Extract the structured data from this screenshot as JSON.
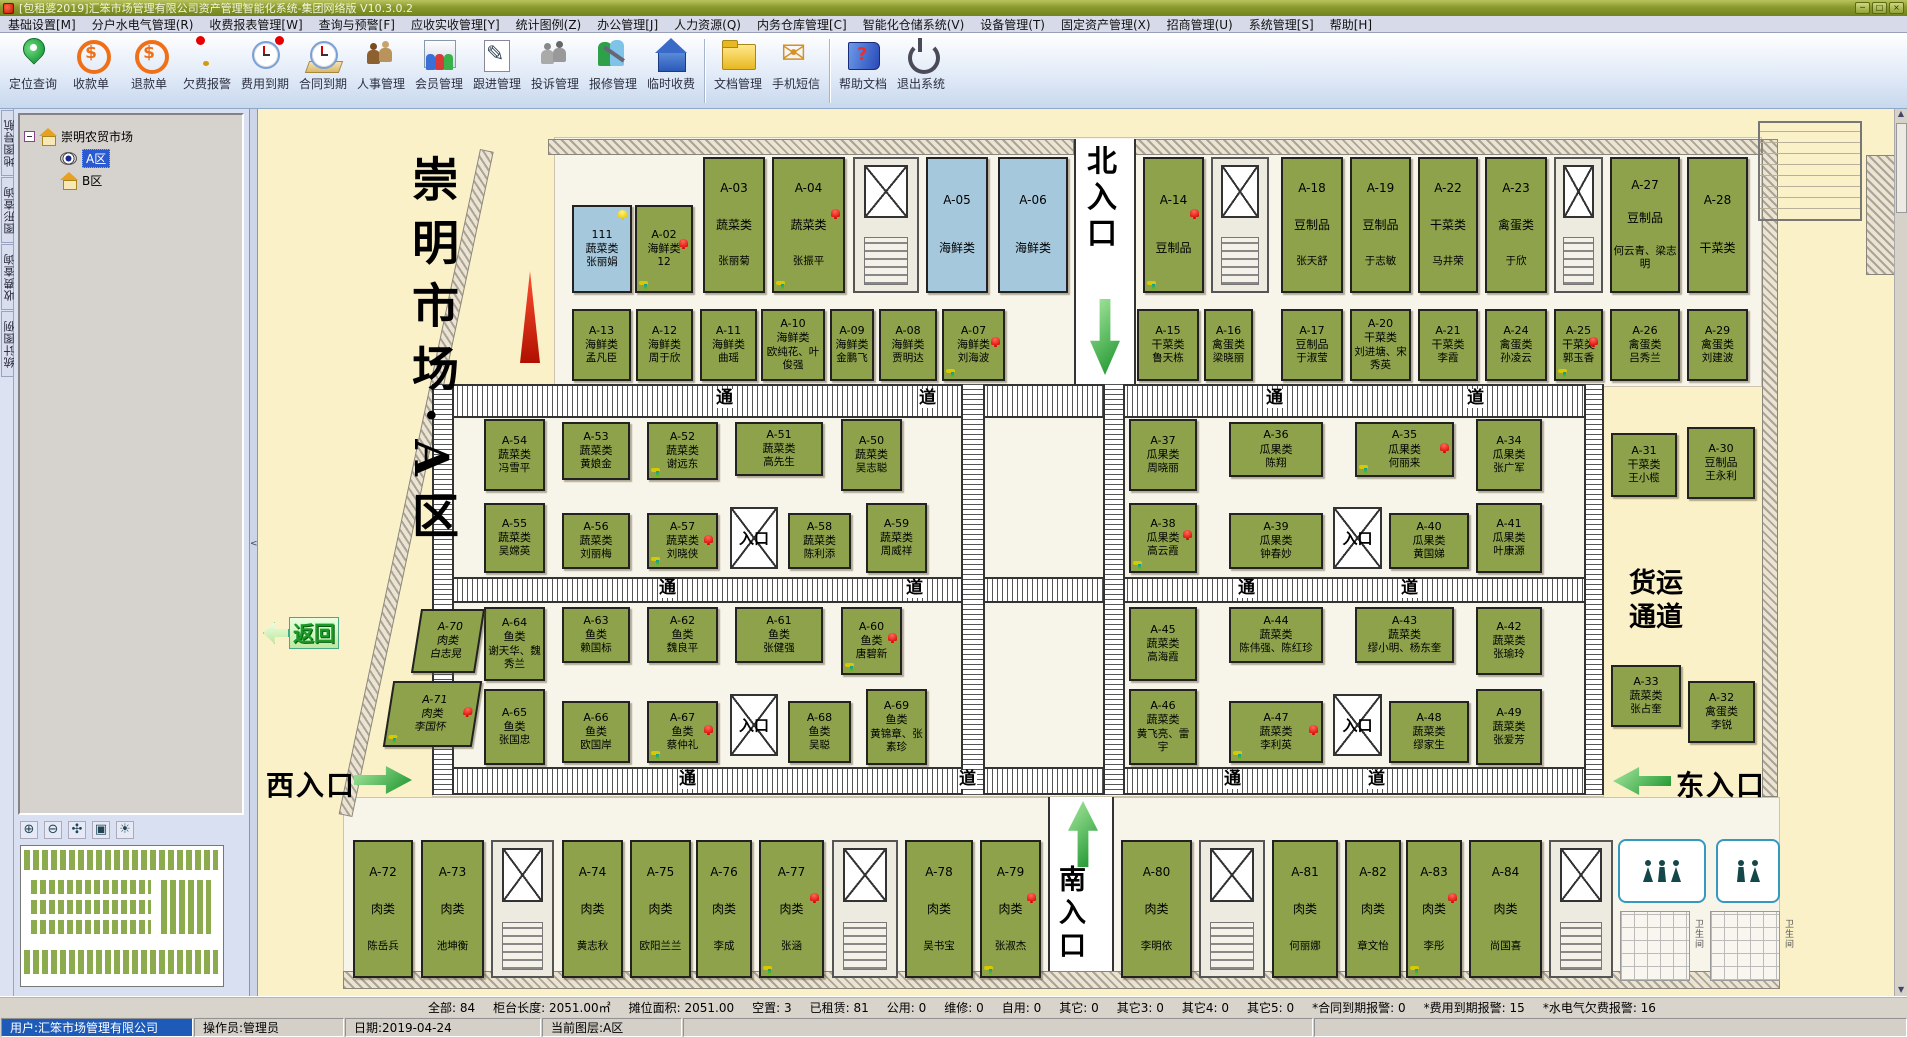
{
  "window": {
    "title": "[包租婆2019]汇笨市场管理有限公司资产管理智能化系统-集团网络版 V10.3.0.2",
    "buttons": {
      "minimize": "─",
      "maximize": "□",
      "close": "×"
    }
  },
  "menu": {
    "items": [
      "基础设置[M]",
      "分户水电气管理(R)",
      "收费报表管理[W]",
      "查询与预警[F]",
      "应收实收管理[Y]",
      "统计图例(Z)",
      "办公管理[J]",
      "人力资源(Q)",
      "内务仓库管理[C]",
      "智能化仓储系统(V)",
      "设备管理(T)",
      "固定资产管理(X)",
      "招商管理(U)",
      "系统管理[S]",
      "帮助[H]"
    ]
  },
  "toolbar": {
    "items": [
      {
        "label": "定位查询",
        "icon": "locate-icon"
      },
      {
        "label": "收款单",
        "icon": "receipt-icon"
      },
      {
        "label": "退款单",
        "icon": "refund-icon"
      },
      {
        "label": "欠费报警",
        "icon": "arrears-alarm-icon"
      },
      {
        "label": "费用到期",
        "icon": "fee-due-icon"
      },
      {
        "label": "合同到期",
        "icon": "contract-due-icon"
      },
      {
        "label": "人事管理",
        "icon": "hr-icon"
      },
      {
        "label": "会员管理",
        "icon": "members-icon"
      },
      {
        "label": "跟进管理",
        "icon": "followup-icon"
      },
      {
        "label": "投诉管理",
        "icon": "complaints-icon"
      },
      {
        "label": "报修管理",
        "icon": "repair-icon"
      },
      {
        "label": "临时收费",
        "icon": "temp-fee-icon"
      },
      {
        "label": "文档管理",
        "icon": "documents-icon"
      },
      {
        "label": "手机短信",
        "icon": "sms-icon"
      },
      {
        "label": "帮助文档",
        "icon": "help-icon"
      },
      {
        "label": "退出系统",
        "icon": "exit-icon"
      }
    ],
    "separators_after": [
      11,
      13
    ]
  },
  "sidebar": {
    "tabs": [
      "地图导航",
      "图形查询",
      "收费查询",
      "统计图例"
    ],
    "tree": {
      "root": "崇明农贸市场",
      "nodes": [
        {
          "label": "A区",
          "selected": true
        },
        {
          "label": "B区",
          "selected": false
        }
      ]
    }
  },
  "map": {
    "labels": {
      "title": "崇明市场·A区",
      "north": "北入口",
      "south": "南入口",
      "west": "西入口",
      "east": "东入口",
      "back": "返回",
      "freight": "货运 通道",
      "entrance": "入口",
      "restroom": "卫生间"
    },
    "colors": {
      "occupied": "#8da24b",
      "vacant": "#a6c8dc",
      "alarm_bell": "#d80000",
      "warn_bell": "#e8c400"
    },
    "corridor_chars": [
      {
        "t": "通",
        "x": 457,
        "y": 280
      },
      {
        "t": "道",
        "x": 660,
        "y": 280
      },
      {
        "t": "通",
        "x": 1007,
        "y": 280
      },
      {
        "t": "道",
        "x": 1208,
        "y": 280
      },
      {
        "t": "通",
        "x": 400,
        "y": 470
      },
      {
        "t": "道",
        "x": 647,
        "y": 470
      },
      {
        "t": "通",
        "x": 979,
        "y": 470
      },
      {
        "t": "道",
        "x": 1142,
        "y": 470
      },
      {
        "t": "通",
        "x": 420,
        "y": 661
      },
      {
        "t": "道",
        "x": 700,
        "y": 661
      },
      {
        "t": "通",
        "x": 965,
        "y": 661
      },
      {
        "t": "道",
        "x": 1109,
        "y": 661
      }
    ],
    "entrance_boxes": [
      {
        "x": 472,
        "y": 398,
        "w": 48,
        "h": 62
      },
      {
        "x": 1075,
        "y": 398,
        "w": 49,
        "h": 62
      },
      {
        "x": 472,
        "y": 585,
        "w": 48,
        "h": 62
      },
      {
        "x": 1075,
        "y": 585,
        "w": 49,
        "h": 62
      }
    ],
    "structs": [
      {
        "x": 595,
        "y": 48,
        "w": 66,
        "h": 136
      },
      {
        "x": 953,
        "y": 48,
        "w": 58,
        "h": 136
      },
      {
        "x": 1296,
        "y": 48,
        "w": 49,
        "h": 136
      },
      {
        "x": 233,
        "y": 731,
        "w": 63,
        "h": 138
      },
      {
        "x": 574,
        "y": 731,
        "w": 66,
        "h": 138
      },
      {
        "x": 941,
        "y": 731,
        "w": 66,
        "h": 138
      },
      {
        "x": 1291,
        "y": 731,
        "w": 64,
        "h": 138
      }
    ],
    "stalls": [
      {
        "i": "111",
        "c": "蔬菜类",
        "n": "张丽娟",
        "x": 314,
        "y": 96,
        "w": 60,
        "h": 88,
        "t": "b",
        "b": "y"
      },
      {
        "i": "A-02",
        "c": "海鲜类",
        "n": "12",
        "x": 377,
        "y": 96,
        "w": 58,
        "h": 88,
        "t": "g",
        "b": "r",
        "tp": 1
      },
      {
        "i": "A-03",
        "c": "蔬菜类",
        "n": "张丽菊",
        "x": 445,
        "y": 48,
        "w": 62,
        "h": 136,
        "t": "g"
      },
      {
        "i": "A-04",
        "c": "蔬菜类",
        "n": "张振平",
        "x": 514,
        "y": 48,
        "w": 73,
        "h": 136,
        "t": "g",
        "b": "r",
        "tp": 1
      },
      {
        "i": "A-05",
        "c": "海鲜类",
        "n": "",
        "x": 668,
        "y": 48,
        "w": 62,
        "h": 136,
        "t": "b"
      },
      {
        "i": "A-06",
        "c": "海鲜类",
        "n": "",
        "x": 740,
        "y": 48,
        "w": 70,
        "h": 136,
        "t": "b"
      },
      {
        "i": "A-14",
        "c": "豆制品",
        "n": "",
        "x": 885,
        "y": 48,
        "w": 61,
        "h": 136,
        "t": "g",
        "b": "r",
        "tp": 1
      },
      {
        "i": "A-18",
        "c": "豆制品",
        "n": "张天舒",
        "x": 1023,
        "y": 48,
        "w": 62,
        "h": 136,
        "t": "g"
      },
      {
        "i": "A-19",
        "c": "豆制品",
        "n": "于志敏",
        "x": 1092,
        "y": 48,
        "w": 61,
        "h": 136,
        "t": "g"
      },
      {
        "i": "A-22",
        "c": "干菜类",
        "n": "马井荣",
        "x": 1160,
        "y": 48,
        "w": 60,
        "h": 136,
        "t": "g"
      },
      {
        "i": "A-23",
        "c": "禽蛋类",
        "n": "于欣",
        "x": 1227,
        "y": 48,
        "w": 62,
        "h": 136,
        "t": "g"
      },
      {
        "i": "A-27",
        "c": "豆制品",
        "n": "何云青、梁志明",
        "x": 1352,
        "y": 48,
        "w": 70,
        "h": 136,
        "t": "g"
      },
      {
        "i": "A-28",
        "c": "干菜类",
        "n": "",
        "x": 1429,
        "y": 48,
        "w": 61,
        "h": 136,
        "t": "g"
      },
      {
        "i": "A-13",
        "c": "海鲜类",
        "n": "孟凡臣",
        "x": 314,
        "y": 200,
        "w": 59,
        "h": 72,
        "t": "g"
      },
      {
        "i": "A-12",
        "c": "海鲜类",
        "n": "周于欣",
        "x": 378,
        "y": 200,
        "w": 57,
        "h": 72,
        "t": "g"
      },
      {
        "i": "A-11",
        "c": "海鲜类",
        "n": "曲瑶",
        "x": 442,
        "y": 200,
        "w": 57,
        "h": 72,
        "t": "g"
      },
      {
        "i": "A-10",
        "c": "海鲜类",
        "n": "欧纯花、叶俊强",
        "x": 503,
        "y": 200,
        "w": 64,
        "h": 72,
        "t": "g"
      },
      {
        "i": "A-09",
        "c": "海鲜类",
        "n": "金鹏飞",
        "x": 572,
        "y": 200,
        "w": 44,
        "h": 72,
        "t": "g"
      },
      {
        "i": "A-08",
        "c": "海鲜类",
        "n": "贾明达",
        "x": 621,
        "y": 200,
        "w": 58,
        "h": 72,
        "t": "g"
      },
      {
        "i": "A-07",
        "c": "海鲜类",
        "n": "刘海波",
        "x": 684,
        "y": 200,
        "w": 63,
        "h": 72,
        "t": "g",
        "b": "r",
        "tp": 1
      },
      {
        "i": "A-15",
        "c": "干菜类",
        "n": "鲁天栋",
        "x": 879,
        "y": 200,
        "w": 62,
        "h": 72,
        "t": "g"
      },
      {
        "i": "A-16",
        "c": "禽蛋类",
        "n": "梁晓丽",
        "x": 946,
        "y": 200,
        "w": 49,
        "h": 72,
        "t": "g"
      },
      {
        "i": "A-17",
        "c": "豆制品",
        "n": "于淑莹",
        "x": 1023,
        "y": 200,
        "w": 62,
        "h": 72,
        "t": "g"
      },
      {
        "i": "A-20",
        "c": "干菜类",
        "n": "刘进塘、宋秀英",
        "x": 1092,
        "y": 200,
        "w": 61,
        "h": 72,
        "t": "g"
      },
      {
        "i": "A-21",
        "c": "干菜类",
        "n": "李霞",
        "x": 1160,
        "y": 200,
        "w": 60,
        "h": 72,
        "t": "g"
      },
      {
        "i": "A-24",
        "c": "禽蛋类",
        "n": "孙凌云",
        "x": 1227,
        "y": 200,
        "w": 62,
        "h": 72,
        "t": "g"
      },
      {
        "i": "A-25",
        "c": "干菜类",
        "n": "郭玉香",
        "x": 1296,
        "y": 200,
        "w": 49,
        "h": 72,
        "t": "g",
        "b": "r",
        "tp": 1
      },
      {
        "i": "A-26",
        "c": "禽蛋类",
        "n": "吕秀兰",
        "x": 1352,
        "y": 200,
        "w": 70,
        "h": 72,
        "t": "g"
      },
      {
        "i": "A-29",
        "c": "禽蛋类",
        "n": "刘建波",
        "x": 1429,
        "y": 200,
        "w": 61,
        "h": 72,
        "t": "g"
      },
      {
        "i": "A-54",
        "c": "蔬菜类",
        "n": "冯雪平",
        "x": 226,
        "y": 310,
        "w": 61,
        "h": 72,
        "t": "g"
      },
      {
        "i": "A-53",
        "c": "蔬菜类",
        "n": "黄娘金",
        "x": 304,
        "y": 313,
        "w": 68,
        "h": 58,
        "t": "g"
      },
      {
        "i": "A-52",
        "c": "蔬菜类",
        "n": "谢远东",
        "x": 389,
        "y": 313,
        "w": 71,
        "h": 58,
        "t": "g",
        "tp": 1
      },
      {
        "i": "A-51",
        "c": "蔬菜类",
        "n": "高先生",
        "x": 477,
        "y": 313,
        "w": 88,
        "h": 54,
        "t": "g"
      },
      {
        "i": "A-50",
        "c": "蔬菜类",
        "n": "吴志聪",
        "x": 583,
        "y": 310,
        "w": 61,
        "h": 72,
        "t": "g"
      },
      {
        "i": "A-37",
        "c": "瓜果类",
        "n": "周晓丽",
        "x": 871,
        "y": 310,
        "w": 68,
        "h": 72,
        "t": "g"
      },
      {
        "i": "A-36",
        "c": "瓜果类",
        "n": "陈翔",
        "x": 971,
        "y": 313,
        "w": 94,
        "h": 55,
        "t": "g"
      },
      {
        "i": "A-35",
        "c": "瓜果类",
        "n": "何丽来",
        "x": 1097,
        "y": 313,
        "w": 99,
        "h": 55,
        "t": "g",
        "b": "r",
        "tp": 1
      },
      {
        "i": "A-34",
        "c": "瓜果类",
        "n": "张广军",
        "x": 1218,
        "y": 310,
        "w": 66,
        "h": 72,
        "t": "g"
      },
      {
        "i": "A-31",
        "c": "干菜类",
        "n": "王小榄",
        "x": 1353,
        "y": 324,
        "w": 66,
        "h": 64,
        "t": "g"
      },
      {
        "i": "A-30",
        "c": "豆制品",
        "n": "王永利",
        "x": 1429,
        "y": 318,
        "w": 68,
        "h": 72,
        "t": "g"
      },
      {
        "i": "A-55",
        "c": "蔬菜类",
        "n": "吴嫦英",
        "x": 226,
        "y": 394,
        "w": 61,
        "h": 70,
        "t": "g"
      },
      {
        "i": "A-56",
        "c": "蔬菜类",
        "n": "刘丽梅",
        "x": 304,
        "y": 404,
        "w": 68,
        "h": 56,
        "t": "g"
      },
      {
        "i": "A-57",
        "c": "蔬菜类",
        "n": "刘晓侠",
        "x": 389,
        "y": 404,
        "w": 71,
        "h": 56,
        "t": "g",
        "b": "r",
        "tp": 1
      },
      {
        "i": "A-58",
        "c": "蔬菜类",
        "n": "陈利添",
        "x": 530,
        "y": 404,
        "w": 63,
        "h": 56,
        "t": "g"
      },
      {
        "i": "A-59",
        "c": "蔬菜类",
        "n": "周威祥",
        "x": 608,
        "y": 394,
        "w": 61,
        "h": 70,
        "t": "g"
      },
      {
        "i": "A-38",
        "c": "瓜果类",
        "n": "高云霞",
        "x": 871,
        "y": 394,
        "w": 68,
        "h": 70,
        "t": "g",
        "b": "r",
        "tp": 1
      },
      {
        "i": "A-39",
        "c": "瓜果类",
        "n": "钟春妙",
        "x": 971,
        "y": 404,
        "w": 94,
        "h": 56,
        "t": "g"
      },
      {
        "i": "A-40",
        "c": "瓜果类",
        "n": "黄国娣",
        "x": 1131,
        "y": 404,
        "w": 80,
        "h": 56,
        "t": "g"
      },
      {
        "i": "A-41",
        "c": "瓜果类",
        "n": "叶康源",
        "x": 1218,
        "y": 394,
        "w": 66,
        "h": 70,
        "t": "g"
      },
      {
        "i": "A-64",
        "c": "鱼类",
        "n": "谢天华、魏秀兰",
        "x": 226,
        "y": 498,
        "w": 61,
        "h": 74,
        "t": "g"
      },
      {
        "i": "A-63",
        "c": "鱼类",
        "n": "赖国标",
        "x": 304,
        "y": 498,
        "w": 68,
        "h": 56,
        "t": "g"
      },
      {
        "i": "A-62",
        "c": "鱼类",
        "n": "魏良平",
        "x": 389,
        "y": 498,
        "w": 71,
        "h": 56,
        "t": "g"
      },
      {
        "i": "A-61",
        "c": "鱼类",
        "n": "张健强",
        "x": 477,
        "y": 498,
        "w": 88,
        "h": 56,
        "t": "g"
      },
      {
        "i": "A-60",
        "c": "鱼类",
        "n": "唐碧新",
        "x": 583,
        "y": 498,
        "w": 61,
        "h": 68,
        "t": "g",
        "b": "r",
        "tp": 1
      },
      {
        "i": "A-45",
        "c": "蔬菜类",
        "n": "高海霞",
        "x": 871,
        "y": 498,
        "w": 68,
        "h": 74,
        "t": "g"
      },
      {
        "i": "A-44",
        "c": "蔬菜类",
        "n": "陈伟强、陈红珍",
        "x": 971,
        "y": 498,
        "w": 94,
        "h": 56,
        "t": "g"
      },
      {
        "i": "A-43",
        "c": "蔬菜类",
        "n": "缪小明、杨东奎",
        "x": 1097,
        "y": 498,
        "w": 99,
        "h": 56,
        "t": "g"
      },
      {
        "i": "A-42",
        "c": "蔬菜类",
        "n": "张瑜玲",
        "x": 1218,
        "y": 498,
        "w": 66,
        "h": 68,
        "t": "g"
      },
      {
        "i": "A-65",
        "c": "鱼类",
        "n": "张国忠",
        "x": 226,
        "y": 580,
        "w": 61,
        "h": 76,
        "t": "g"
      },
      {
        "i": "A-66",
        "c": "鱼类",
        "n": "欧国岸",
        "x": 304,
        "y": 592,
        "w": 68,
        "h": 62,
        "t": "g"
      },
      {
        "i": "A-67",
        "c": "鱼类",
        "n": "蔡仲礼",
        "x": 389,
        "y": 592,
        "w": 71,
        "h": 62,
        "t": "g",
        "b": "r",
        "tp": 1
      },
      {
        "i": "A-68",
        "c": "鱼类",
        "n": "吴聪",
        "x": 530,
        "y": 592,
        "w": 63,
        "h": 62,
        "t": "g"
      },
      {
        "i": "A-69",
        "c": "鱼类",
        "n": "黄锦章、张素珍",
        "x": 608,
        "y": 580,
        "w": 61,
        "h": 76,
        "t": "g"
      },
      {
        "i": "A-46",
        "c": "蔬菜类",
        "n": "黄飞亮、雷宇",
        "x": 871,
        "y": 580,
        "w": 68,
        "h": 76,
        "t": "g"
      },
      {
        "i": "A-47",
        "c": "蔬菜类",
        "n": "李利英",
        "x": 971,
        "y": 592,
        "w": 94,
        "h": 62,
        "t": "g",
        "b": "r",
        "tp": 1
      },
      {
        "i": "A-48",
        "c": "蔬菜类",
        "n": "缪家生",
        "x": 1131,
        "y": 592,
        "w": 80,
        "h": 62,
        "t": "g"
      },
      {
        "i": "A-49",
        "c": "蔬菜类",
        "n": "张爱芳",
        "x": 1218,
        "y": 580,
        "w": 66,
        "h": 76,
        "t": "g"
      },
      {
        "i": "A-33",
        "c": "蔬菜类",
        "n": "张占奎",
        "x": 1353,
        "y": 556,
        "w": 70,
        "h": 62,
        "t": "g"
      },
      {
        "i": "A-32",
        "c": "禽蛋类",
        "n": "李锐",
        "x": 1430,
        "y": 572,
        "w": 67,
        "h": 62,
        "t": "g"
      },
      {
        "i": "A-70",
        "c": "肉类",
        "n": "白志晃",
        "x": 158,
        "y": 500,
        "w": 64,
        "h": 64,
        "t": "g",
        "sk": 1
      },
      {
        "i": "A-71",
        "c": "肉类",
        "n": "李国怀",
        "x": 130,
        "y": 572,
        "w": 89,
        "h": 66,
        "t": "g",
        "b": "r",
        "tp": 1,
        "sk": 1
      },
      {
        "i": "A-72",
        "c": "肉类",
        "n": "陈岳兵",
        "x": 95,
        "y": 731,
        "w": 60,
        "h": 138,
        "t": "g"
      },
      {
        "i": "A-73",
        "c": "肉类",
        "n": "池坤衡",
        "x": 163,
        "y": 731,
        "w": 63,
        "h": 138,
        "t": "g"
      },
      {
        "i": "A-74",
        "c": "肉类",
        "n": "黄志秋",
        "x": 304,
        "y": 731,
        "w": 61,
        "h": 138,
        "t": "g"
      },
      {
        "i": "A-75",
        "c": "肉类",
        "n": "欧阳兰兰",
        "x": 372,
        "y": 731,
        "w": 61,
        "h": 138,
        "t": "g"
      },
      {
        "i": "A-76",
        "c": "肉类",
        "n": "李成",
        "x": 438,
        "y": 731,
        "w": 56,
        "h": 138,
        "t": "g"
      },
      {
        "i": "A-77",
        "c": "肉类",
        "n": "张涵",
        "x": 501,
        "y": 731,
        "w": 65,
        "h": 138,
        "t": "g",
        "b": "r",
        "tp": 1
      },
      {
        "i": "A-78",
        "c": "肉类",
        "n": "吴书宝",
        "x": 647,
        "y": 731,
        "w": 68,
        "h": 138,
        "t": "g"
      },
      {
        "i": "A-79",
        "c": "肉类",
        "n": "张淑杰",
        "x": 722,
        "y": 731,
        "w": 61,
        "h": 138,
        "t": "g",
        "b": "r",
        "tp": 1
      },
      {
        "i": "A-80",
        "c": "肉类",
        "n": "李明依",
        "x": 863,
        "y": 731,
        "w": 71,
        "h": 138,
        "t": "g"
      },
      {
        "i": "A-81",
        "c": "肉类",
        "n": "何丽娜",
        "x": 1014,
        "y": 731,
        "w": 66,
        "h": 138,
        "t": "g"
      },
      {
        "i": "A-82",
        "c": "肉类",
        "n": "章文怡",
        "x": 1087,
        "y": 731,
        "w": 56,
        "h": 138,
        "t": "g"
      },
      {
        "i": "A-83",
        "c": "肉类",
        "n": "李彤",
        "x": 1148,
        "y": 731,
        "w": 56,
        "h": 138,
        "t": "g",
        "b": "r",
        "tp": 1
      },
      {
        "i": "A-84",
        "c": "肉类",
        "n": "尚国喜",
        "x": 1211,
        "y": 731,
        "w": 73,
        "h": 138,
        "t": "g"
      }
    ]
  },
  "statusbar": {
    "items": [
      "全部: 84",
      "柜台长度: 2051.00㎡",
      "摊位面积: 2051.00",
      "空置: 3",
      "已租赁: 81",
      "公用: 0",
      "维修: 0",
      "自用: 0",
      "其它: 0",
      "其它3: 0",
      "其它4: 0",
      "其它5: 0",
      "*合同到期报警: 0",
      "*费用到期报警: 15",
      "*水电气欠费报警: 16"
    ]
  },
  "bottombar": {
    "user": "用户:汇笨市场管理有限公司",
    "operator": "操作员:管理员",
    "date": "日期:2019-04-24",
    "layer": "当前图层:A区"
  }
}
